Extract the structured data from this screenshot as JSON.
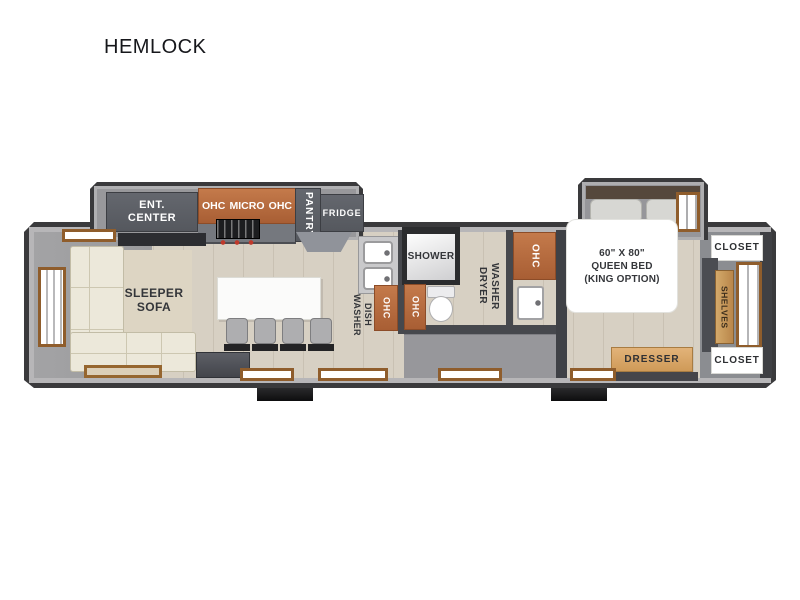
{
  "title": "HEMLOCK",
  "colors": {
    "wall_outline": "#3a3a3c",
    "wall_fill": "#b7b6b8",
    "cabinet_orange": "#b2673e",
    "appliance_gray": "#5c5f66",
    "wood_floor": "#d7d0c3",
    "label_text": "#34363a"
  },
  "rooms": {
    "living": {
      "ent_center": "ENT.\nCENTER",
      "ohc_left": "OHC",
      "micro": "MICRO",
      "ohc_right": "OHC",
      "pantry": "PANTRY",
      "fridge": "FRIDGE",
      "sofa": "SLEEPER\nSOFA"
    },
    "kitchen": {
      "dishwasher": "DISH\nWASHER",
      "ohc": "OHC"
    },
    "bath": {
      "shower": "SHOWER",
      "ohc_shower": "OHC",
      "washer_dryer": "WASHER\nDRYER",
      "ohc_vanity": "OHC"
    },
    "bedroom": {
      "bed": "60\" X 80\"\nQUEEN BED\n(KING OPTION)",
      "dresser": "DRESSER",
      "closet_top": "CLOSET",
      "shelves": "SHELVES",
      "closet_bottom": "CLOSET"
    }
  }
}
